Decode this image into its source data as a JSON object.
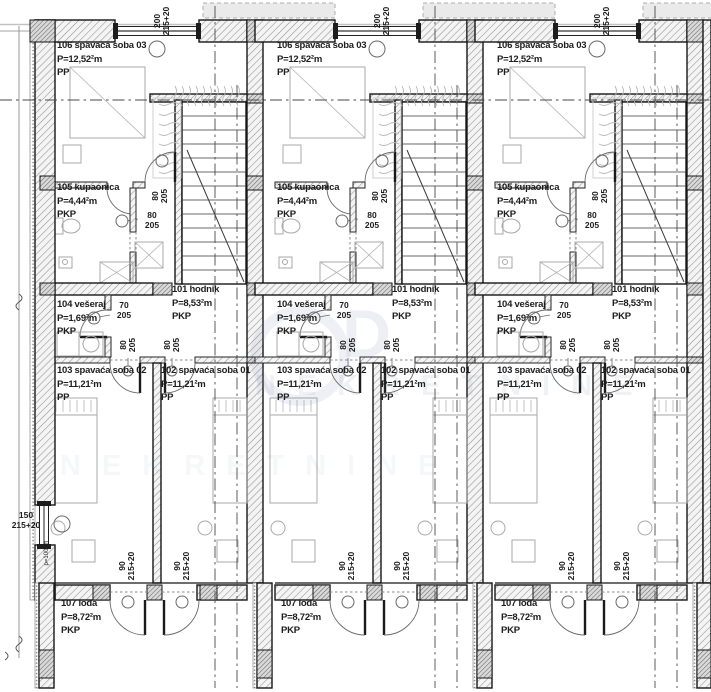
{
  "drawing_type": "floor plan",
  "colors": {
    "line": "#161616",
    "hatch": "#8f8f8f",
    "watermark": "#7d8eaf"
  },
  "watermark": {
    "logo_text": "D",
    "name_text": "NEKRETNINE"
  },
  "left_window": {
    "w": "150",
    "h": "215+20",
    "parapet": "p=100cm"
  },
  "units": [
    {
      "name": "Unit 1",
      "rooms": {
        "bedroom03": {
          "label": "106 spavaća soba 03",
          "area": "P=12,52²m",
          "finish": "PP"
        },
        "bathroom": {
          "label": "105 kupaonica",
          "area": "P=4,44²m",
          "finish": "PKP"
        },
        "hallway": {
          "label": "101 hodnik",
          "area": "P=8,53²m",
          "finish": "PKP"
        },
        "laundry": {
          "label": "104 vešeraj",
          "area": "P=1,69²m",
          "finish": "PKP"
        },
        "bedroom02": {
          "label": "103 spavaća soba 02",
          "area": "P=11,21²m",
          "finish": "PP"
        },
        "bedroom01": {
          "label": "102 spavaća soba 01",
          "area": "P=11,21²m",
          "finish": "PP"
        },
        "loggia": {
          "label": "107 lođa",
          "area": "P=8,72²m",
          "finish": "PKP"
        }
      },
      "dims": {
        "top_window": {
          "w": "200",
          "h": "215+20"
        },
        "bedroom03_door": {
          "w": "80",
          "h": "205"
        },
        "bathroom_door": {
          "w": "80",
          "h": "205"
        },
        "laundry_door": {
          "w": "70",
          "h": "205"
        },
        "bedroom02_door": {
          "w": "80",
          "h": "205"
        },
        "bedroom01_door": {
          "w": "80",
          "h": "205"
        },
        "loggia_door_left": {
          "w": "90",
          "h": "215+20"
        },
        "loggia_door_right": {
          "w": "90",
          "h": "215+20"
        }
      }
    },
    {
      "name": "Unit 2",
      "rooms": {
        "bedroom03": {
          "label": "106 spavaća soba 03",
          "area": "P=12,52²m",
          "finish": "PP"
        },
        "bathroom": {
          "label": "105 kupaonica",
          "area": "P=4,44²m",
          "finish": "PKP"
        },
        "hallway": {
          "label": "101 hodnik",
          "area": "P=8,53²m",
          "finish": "PKP"
        },
        "laundry": {
          "label": "104 vešeraj",
          "area": "P=1,69²m",
          "finish": "PKP"
        },
        "bedroom02": {
          "label": "103 spavaća soba 02",
          "area": "P=11,21²m",
          "finish": "PP"
        },
        "bedroom01": {
          "label": "102 spavaća soba 01",
          "area": "P=11,21²m",
          "finish": "PP"
        },
        "loggia": {
          "label": "107 lođa",
          "area": "P=8,72²m",
          "finish": "PKP"
        }
      },
      "dims": {
        "top_window": {
          "w": "200",
          "h": "215+20"
        },
        "bedroom03_door": {
          "w": "80",
          "h": "205"
        },
        "bathroom_door": {
          "w": "80",
          "h": "205"
        },
        "laundry_door": {
          "w": "70",
          "h": "205"
        },
        "bedroom02_door": {
          "w": "80",
          "h": "205"
        },
        "bedroom01_door": {
          "w": "80",
          "h": "205"
        },
        "loggia_door_left": {
          "w": "90",
          "h": "215+20"
        },
        "loggia_door_right": {
          "w": "90",
          "h": "215+20"
        }
      }
    },
    {
      "name": "Unit 3",
      "rooms": {
        "bedroom03": {
          "label": "106 spavaća soba 03",
          "area": "P=12,52²m",
          "finish": "PP"
        },
        "bathroom": {
          "label": "105 kupaonica",
          "area": "P=4,44²m",
          "finish": "PKP"
        },
        "hallway": {
          "label": "101 hodnik",
          "area": "P=8,53²m",
          "finish": "PKP"
        },
        "laundry": {
          "label": "104 vešeraj",
          "area": "P=1,69²m",
          "finish": "PKP"
        },
        "bedroom02": {
          "label": "103 spavaća soba 02",
          "area": "P=11,21²m",
          "finish": "PP"
        },
        "bedroom01": {
          "label": "102 spavaća soba 01",
          "area": "P=11,21²m",
          "finish": "PP"
        },
        "loggia": {
          "label": "107 lođa",
          "area": "P=8,72²m",
          "finish": "PKP"
        }
      },
      "dims": {
        "top_window": {
          "w": "200",
          "h": "215+20"
        },
        "bedroom03_door": {
          "w": "80",
          "h": "205"
        },
        "bathroom_door": {
          "w": "80",
          "h": "205"
        },
        "laundry_door": {
          "w": "70",
          "h": "205"
        },
        "bedroom02_door": {
          "w": "80",
          "h": "205"
        },
        "bedroom01_door": {
          "w": "80",
          "h": "205"
        },
        "loggia_door_left": {
          "w": "90",
          "h": "215+20"
        },
        "loggia_door_right": {
          "w": "90",
          "h": "215+20"
        }
      }
    }
  ]
}
